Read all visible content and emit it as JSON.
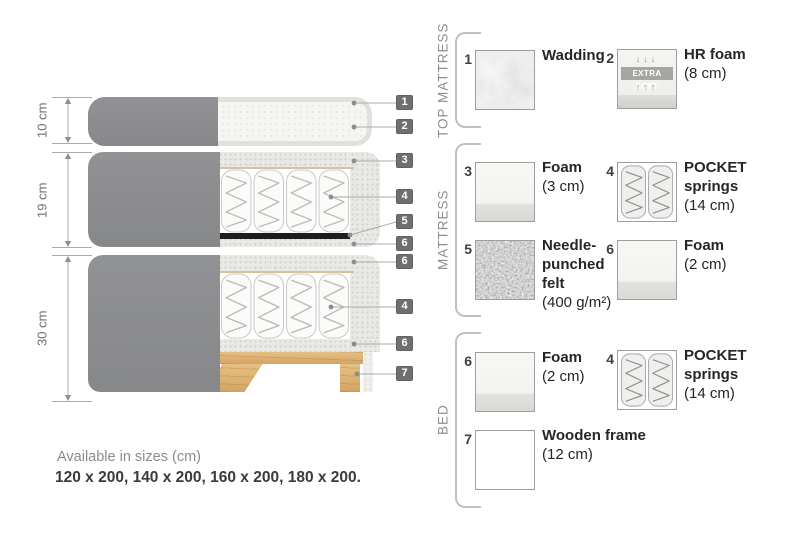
{
  "diagram": {
    "dims": [
      {
        "label": "10 cm"
      },
      {
        "label": "19 cm"
      },
      {
        "label": "30 cm"
      }
    ],
    "callouts": [
      {
        "num": "1"
      },
      {
        "num": "2"
      },
      {
        "num": "3"
      },
      {
        "num": "4"
      },
      {
        "num": "5"
      },
      {
        "num": "6"
      },
      {
        "num": "6"
      },
      {
        "num": "4"
      },
      {
        "num": "6"
      },
      {
        "num": "7"
      }
    ]
  },
  "legend": {
    "sections": [
      {
        "title": "TOP MATTRESS",
        "items": [
          {
            "num": "1",
            "name": "Wadding",
            "detail": ""
          },
          {
            "num": "2",
            "name": "HR foam",
            "detail": "(8 cm)",
            "swatch_label": "EXTRA SOFT",
            "arrows_down": "↓↓↓",
            "arrows_up": "↑↑↑"
          }
        ]
      },
      {
        "title": "MATTRESS",
        "items": [
          {
            "num": "3",
            "name": "Foam",
            "detail": "(3 cm)"
          },
          {
            "num": "4",
            "name": "POCKET springs",
            "detail": "(14 cm)"
          },
          {
            "num": "5",
            "name": "Needle-punched felt",
            "detail": "(400 g/m²)"
          },
          {
            "num": "6",
            "name": "Foam",
            "detail": "(2 cm)"
          }
        ]
      },
      {
        "title": "BED",
        "items": [
          {
            "num": "6",
            "name": "Foam",
            "detail": "(2 cm)"
          },
          {
            "num": "4",
            "name": "POCKET springs",
            "detail": "(14 cm)"
          },
          {
            "num": "7",
            "name": "Wooden frame",
            "detail": "(12 cm)"
          }
        ]
      }
    ]
  },
  "footer": {
    "line1": "Available in sizes (cm)",
    "line2": "120 x 200, 140 x 200, 160 x 200, 180 x 200."
  },
  "colors": {
    "fabric": "#8d8e90",
    "badge": "#6f6f71",
    "wood": "#dcb172",
    "felt_band": "#1d1d1d",
    "quilt_edge": "#dde3dc",
    "tan_line": "#d9c099"
  }
}
